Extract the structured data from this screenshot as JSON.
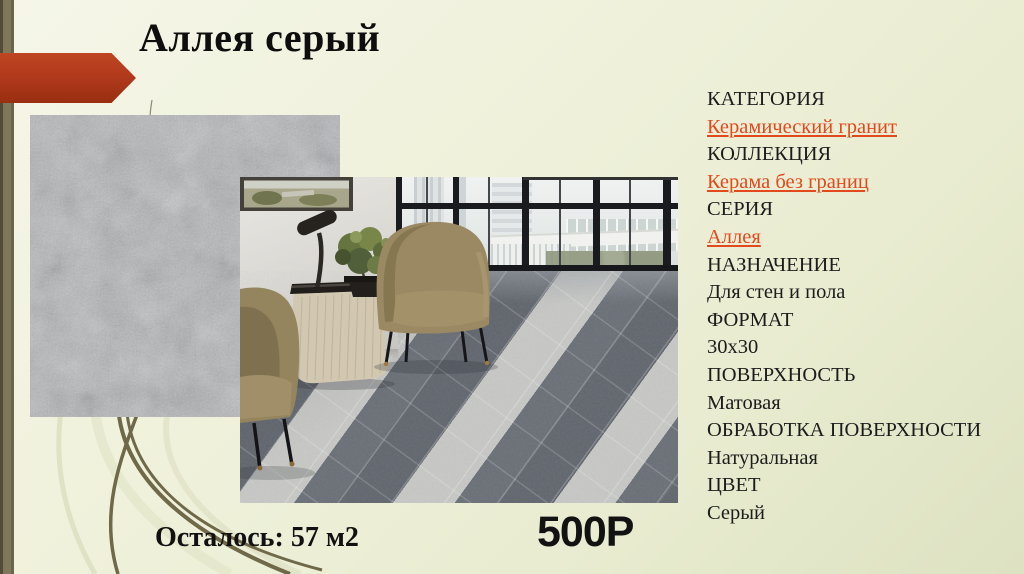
{
  "slide": {
    "title": "Аллея серый",
    "stock": "Осталось: 57 м2",
    "price": "500Р"
  },
  "attributes": [
    {
      "label": "КАТЕГОРИЯ",
      "value": "Керамический гранит",
      "link": true
    },
    {
      "label": "КОЛЛЕКЦИЯ",
      "value": "Керама без границ",
      "link": true
    },
    {
      "label": "СЕРИЯ",
      "value": "Аллея",
      "link": true
    },
    {
      "label": "НАЗНАЧЕНИЕ",
      "value": "Для стен и пола",
      "link": false
    },
    {
      "label": "ФОРМАТ",
      "value": "30x30",
      "link": false
    },
    {
      "label": "ПОВЕРХНОСТЬ",
      "value": "Матовая",
      "link": false
    },
    {
      "label": "ОБРАБОТКА ПОВЕРХНОСТИ",
      "value": "Натуральная",
      "link": false
    },
    {
      "label": "ЦВЕТ",
      "value": "Серый",
      "link": false
    }
  ],
  "colors": {
    "background": "#eef0d8",
    "accent_arrow": "#b23a1c",
    "link": "#e2491c",
    "side_strip": "#7e7759",
    "title_text": "#0e0e0e"
  }
}
